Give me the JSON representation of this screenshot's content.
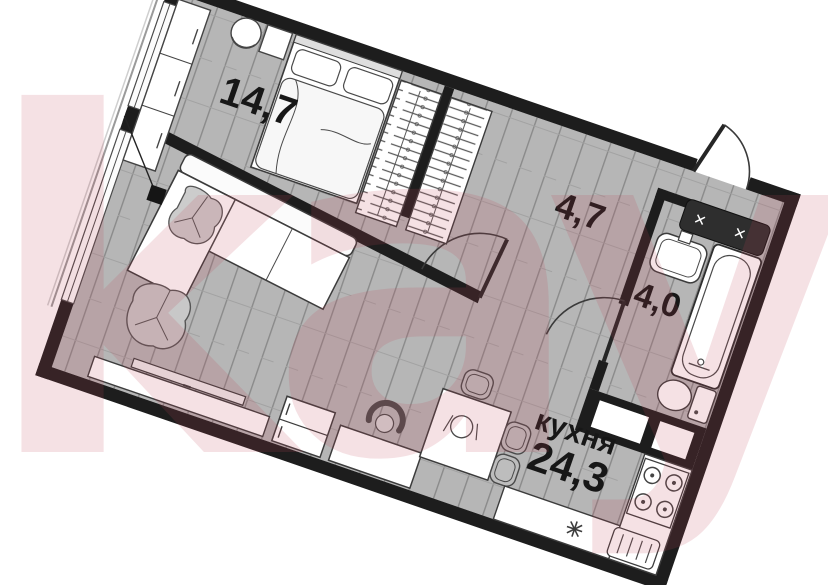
{
  "watermark": {
    "text": "kayan",
    "color": "#c04658"
  },
  "rooms": {
    "bedroom": {
      "area": "14,7"
    },
    "hallway": {
      "area": "4,7"
    },
    "bathroom": {
      "area": "4,0"
    },
    "kitchen": {
      "name": "кухня",
      "area": "24,3"
    }
  },
  "icons": {
    "shaft_cross": "✕"
  },
  "colors": {
    "wall": "#1d1d1d",
    "floor": "#b6b6b6",
    "floor_line": "#8a8a8a",
    "furniture_outline": "#444444",
    "watermark_pink": "#c04658"
  }
}
